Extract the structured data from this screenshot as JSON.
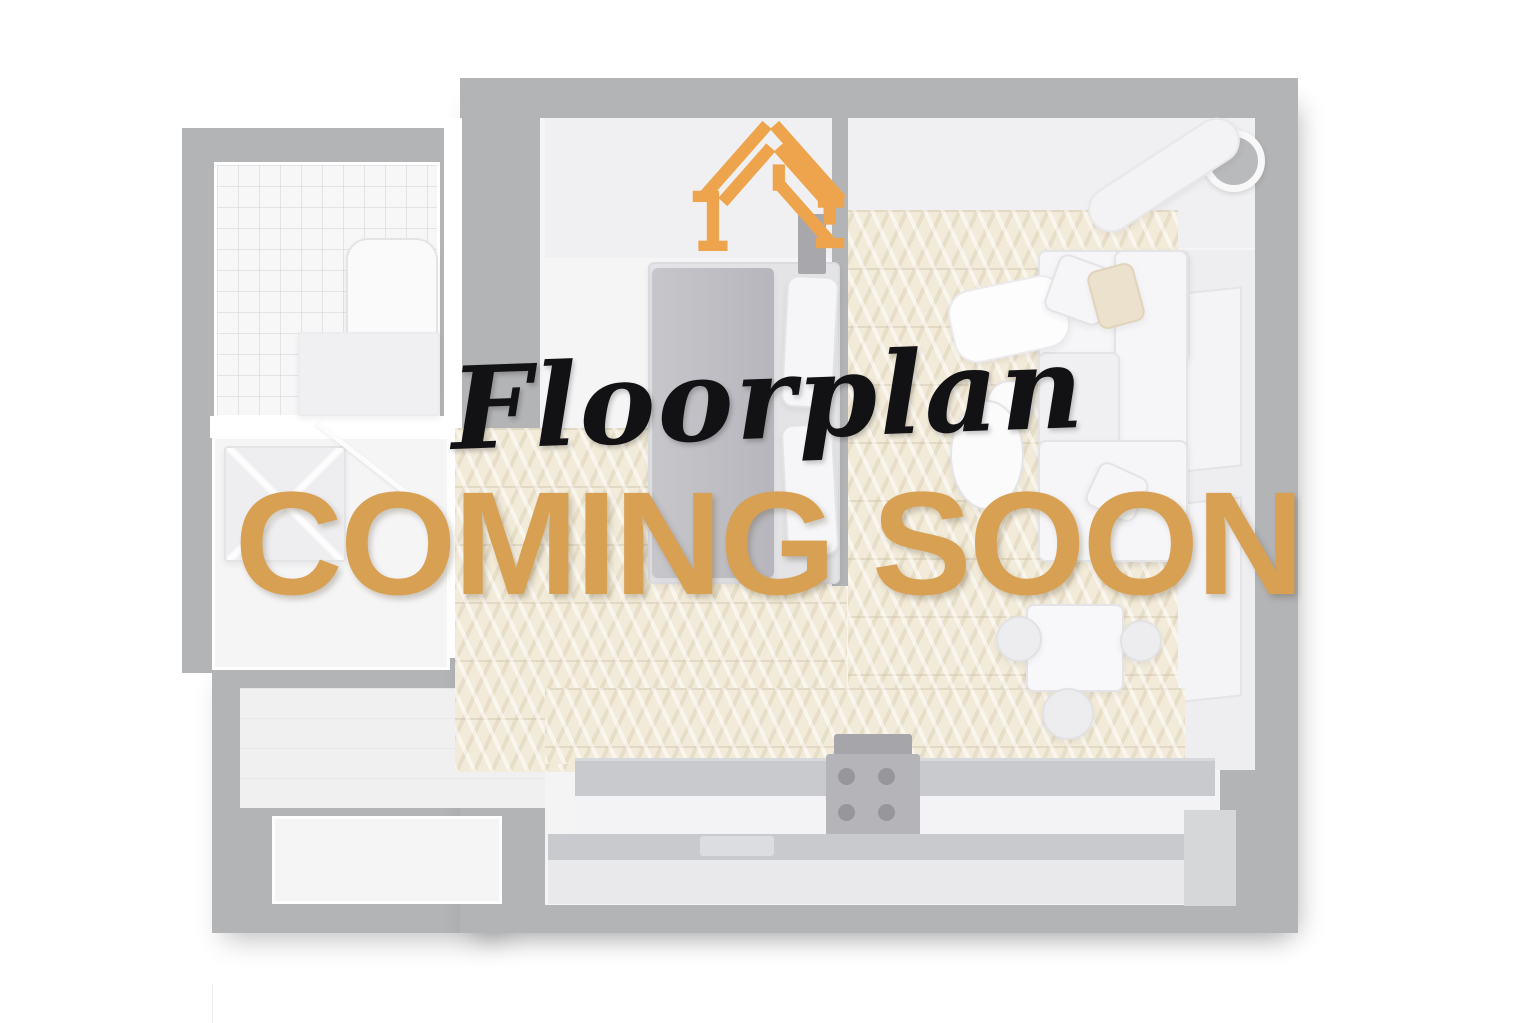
{
  "overlay": {
    "script_title": "Floorplan",
    "main_title": "COMING SOON"
  },
  "logo": {
    "icon": "house-frame-logo-icon",
    "color": "#EEA44C"
  },
  "colors": {
    "title_orange": "#D8A052",
    "logo_orange": "#EEA44C",
    "script_black": "#121214",
    "wall_gray": "#B3B4B6",
    "floor_beige": "#F2EBD9",
    "room_white": "#F5F5F6",
    "background": "#FFFFFF"
  },
  "floorplan": {
    "style": "faded top-down 3D apartment render",
    "rooms": [
      "bathroom",
      "shower-room",
      "entry",
      "hallway",
      "bedroom",
      "living-room",
      "dining-area",
      "kitchen"
    ]
  }
}
